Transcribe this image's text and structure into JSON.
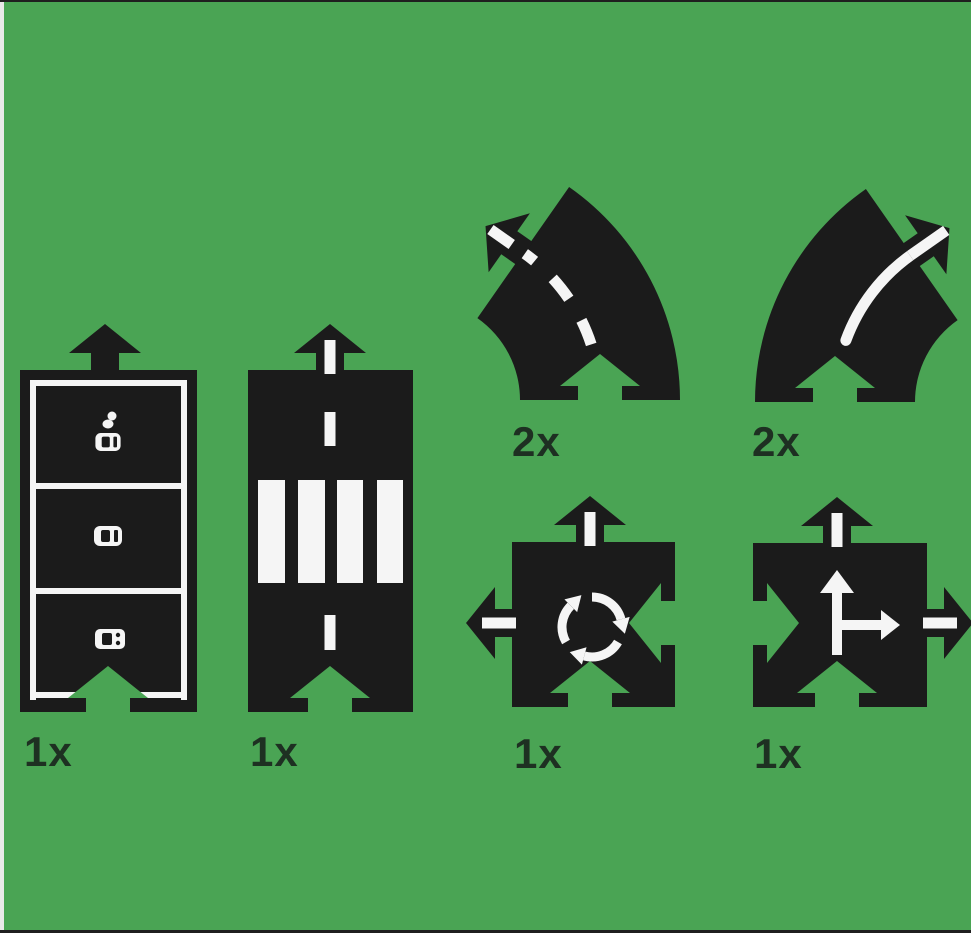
{
  "colors": {
    "background": "#4aa454",
    "piece": "#1b1b1b",
    "marking": "#f5f5f5",
    "label": "#1e3022",
    "edge_strip": "#e9e9e9",
    "edge_line": "#1f1f1f"
  },
  "pieces": [
    {
      "name": "parking-lot",
      "count_label": "1x"
    },
    {
      "name": "straight-with-pedestrian-crossing",
      "count_label": "1x"
    },
    {
      "name": "curve-dashed-line",
      "count_label": "2x"
    },
    {
      "name": "curve-solid-line",
      "count_label": "2x"
    },
    {
      "name": "roundabout",
      "count_label": "1x"
    },
    {
      "name": "t-junction",
      "count_label": "1x"
    }
  ]
}
